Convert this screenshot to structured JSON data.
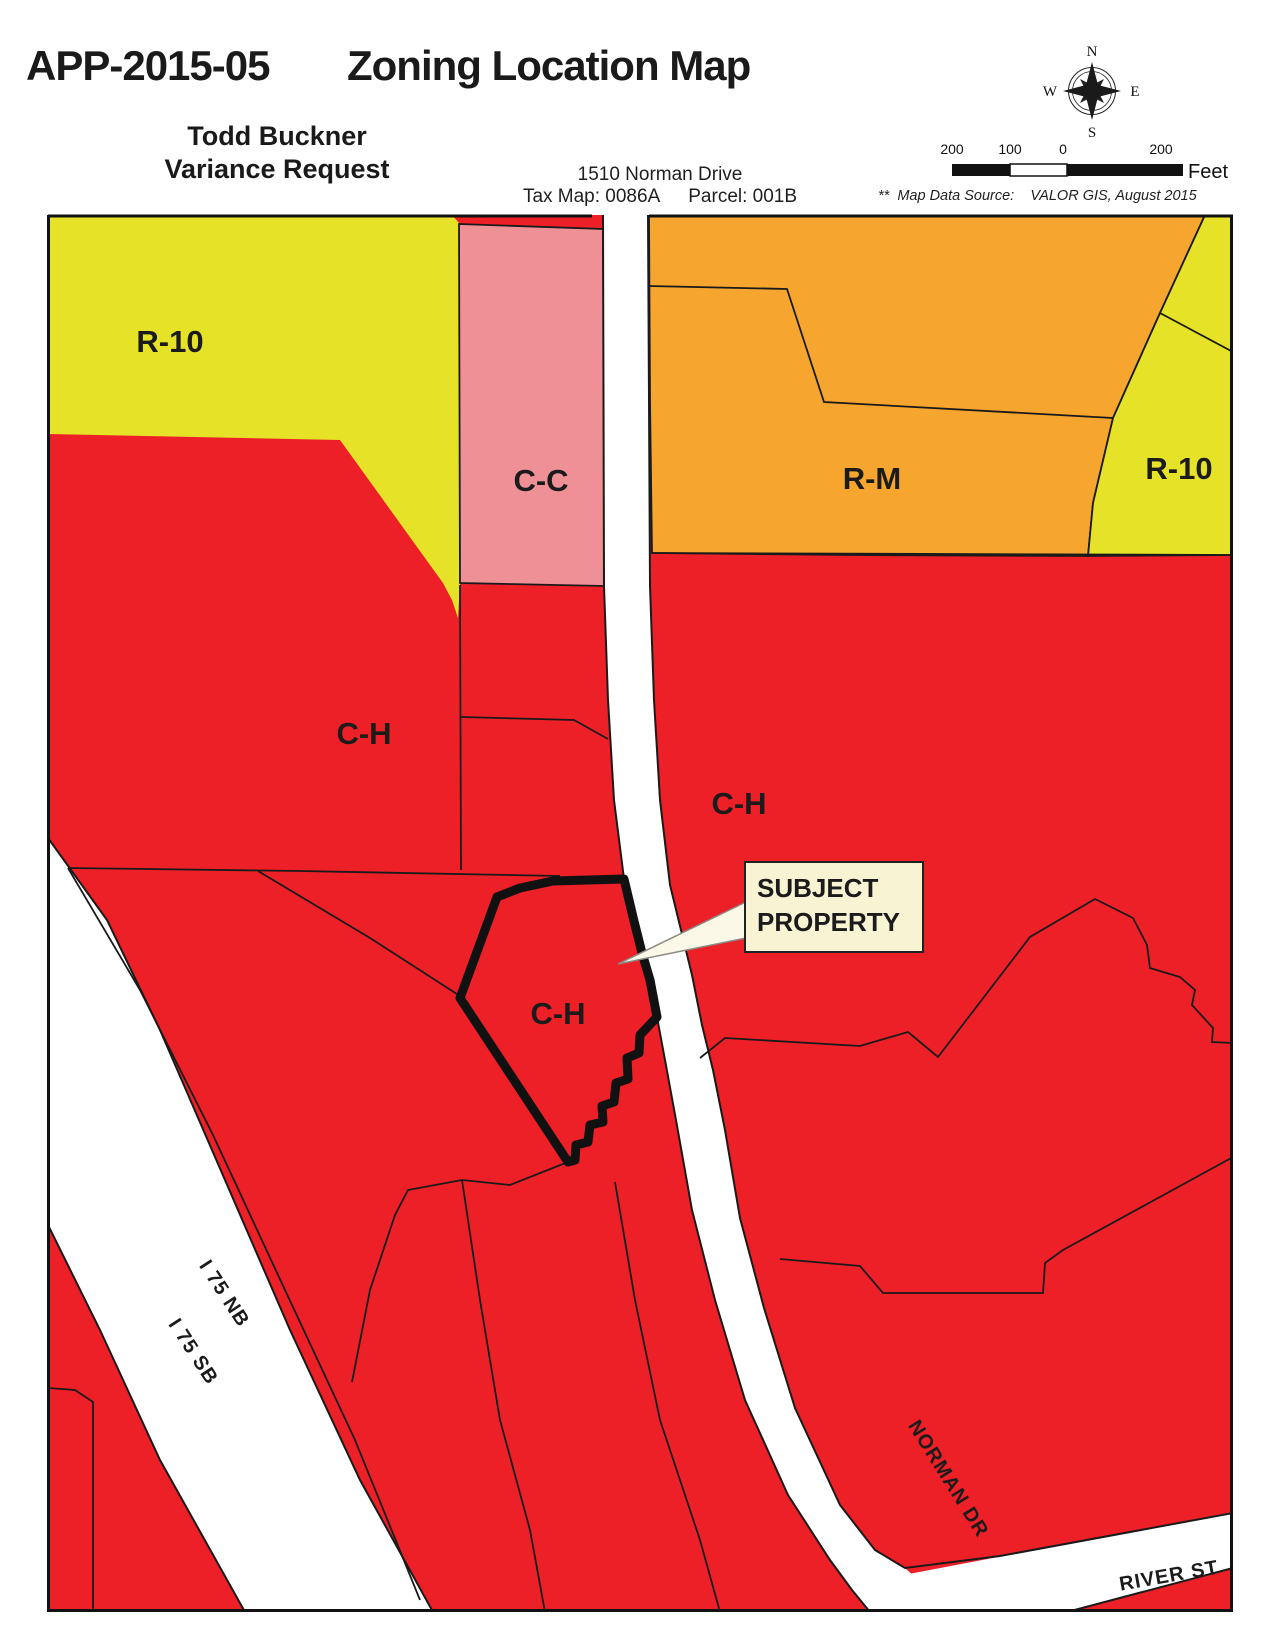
{
  "header": {
    "app_number": "APP-2015-05",
    "title": "Zoning Location Map",
    "applicant_line1": "Todd Buckner",
    "applicant_line2": "Variance Request",
    "address_line": "1510 Norman Drive",
    "tax_map": "Tax Map: 0086A",
    "parcel": "Parcel: 001B",
    "source_note": "**  Map Data Source:    VALOR GIS, August 2015"
  },
  "compass": {
    "north": "N",
    "south": "S",
    "east": "E",
    "west": "W"
  },
  "scalebar": {
    "t1": "200",
    "t2": "100",
    "t3": "0",
    "t4": "200",
    "unit": "Feet"
  },
  "map": {
    "colors": {
      "zone_red": "#ed2027",
      "zone_yellow": "#e5e228",
      "zone_orange": "#f6a62f",
      "zone_pink": "#ef8f96",
      "road_white": "#ffffff",
      "callout_bg": "#f7f3d3",
      "leader_fill": "#fbf8e8",
      "outline": "#1a1a1a"
    },
    "zones": {
      "r10_left": "R-10",
      "cc": "C-C",
      "rm": "R-M",
      "r10_right": "R-10",
      "ch_left": "C-H",
      "ch_right": "C-H",
      "ch_subject": "C-H"
    },
    "roads": {
      "i75nb": "I 75 NB",
      "i75sb": "I 75 SB",
      "norman": "NORMAN DR",
      "river": "RIVER ST"
    },
    "callout": {
      "line1": "SUBJECT",
      "line2": "PROPERTY"
    }
  }
}
